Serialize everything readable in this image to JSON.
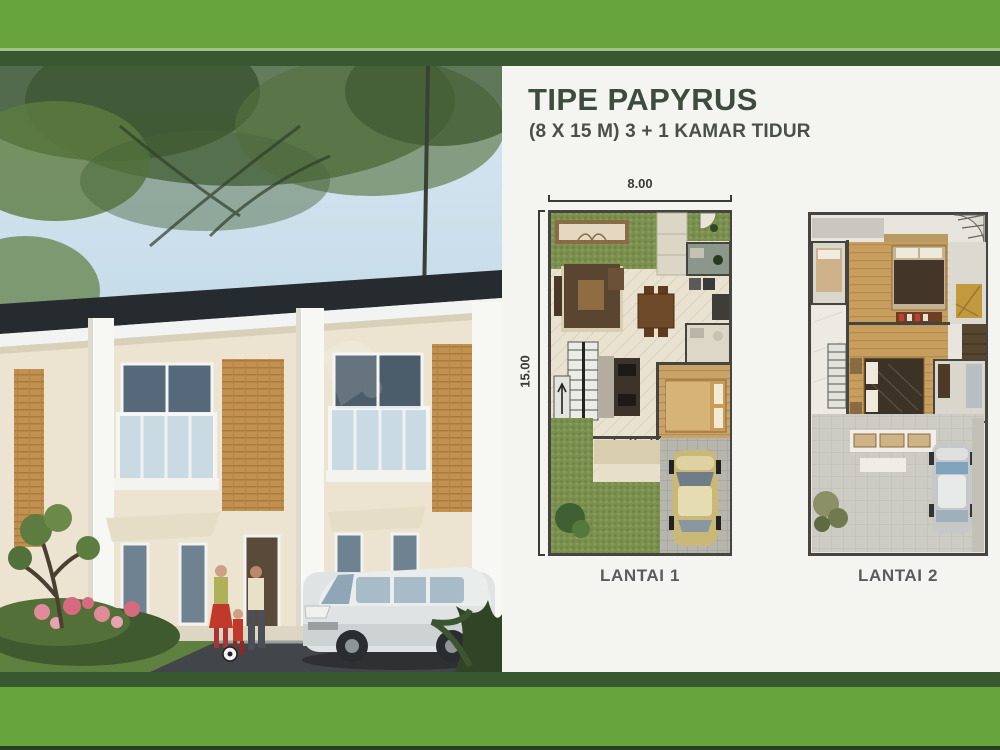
{
  "frame": {
    "accent_green": "#68a43d",
    "dark_green": "#38592f"
  },
  "panel": {
    "title": "TIPE PAPYRUS",
    "subtitle": "(8 X 15 M) 3 + 1 KAMAR TIDUR",
    "title_color": "#3e4c3e"
  },
  "plans": [
    {
      "caption": "LANTAI 1",
      "width_label": "8.00",
      "height_label": "15.00"
    },
    {
      "caption": "LANTAI 2"
    }
  ],
  "photo": {
    "alt": "Rendering of two-storey terrace houses with trees, a family playing soccer and a white MPV"
  }
}
